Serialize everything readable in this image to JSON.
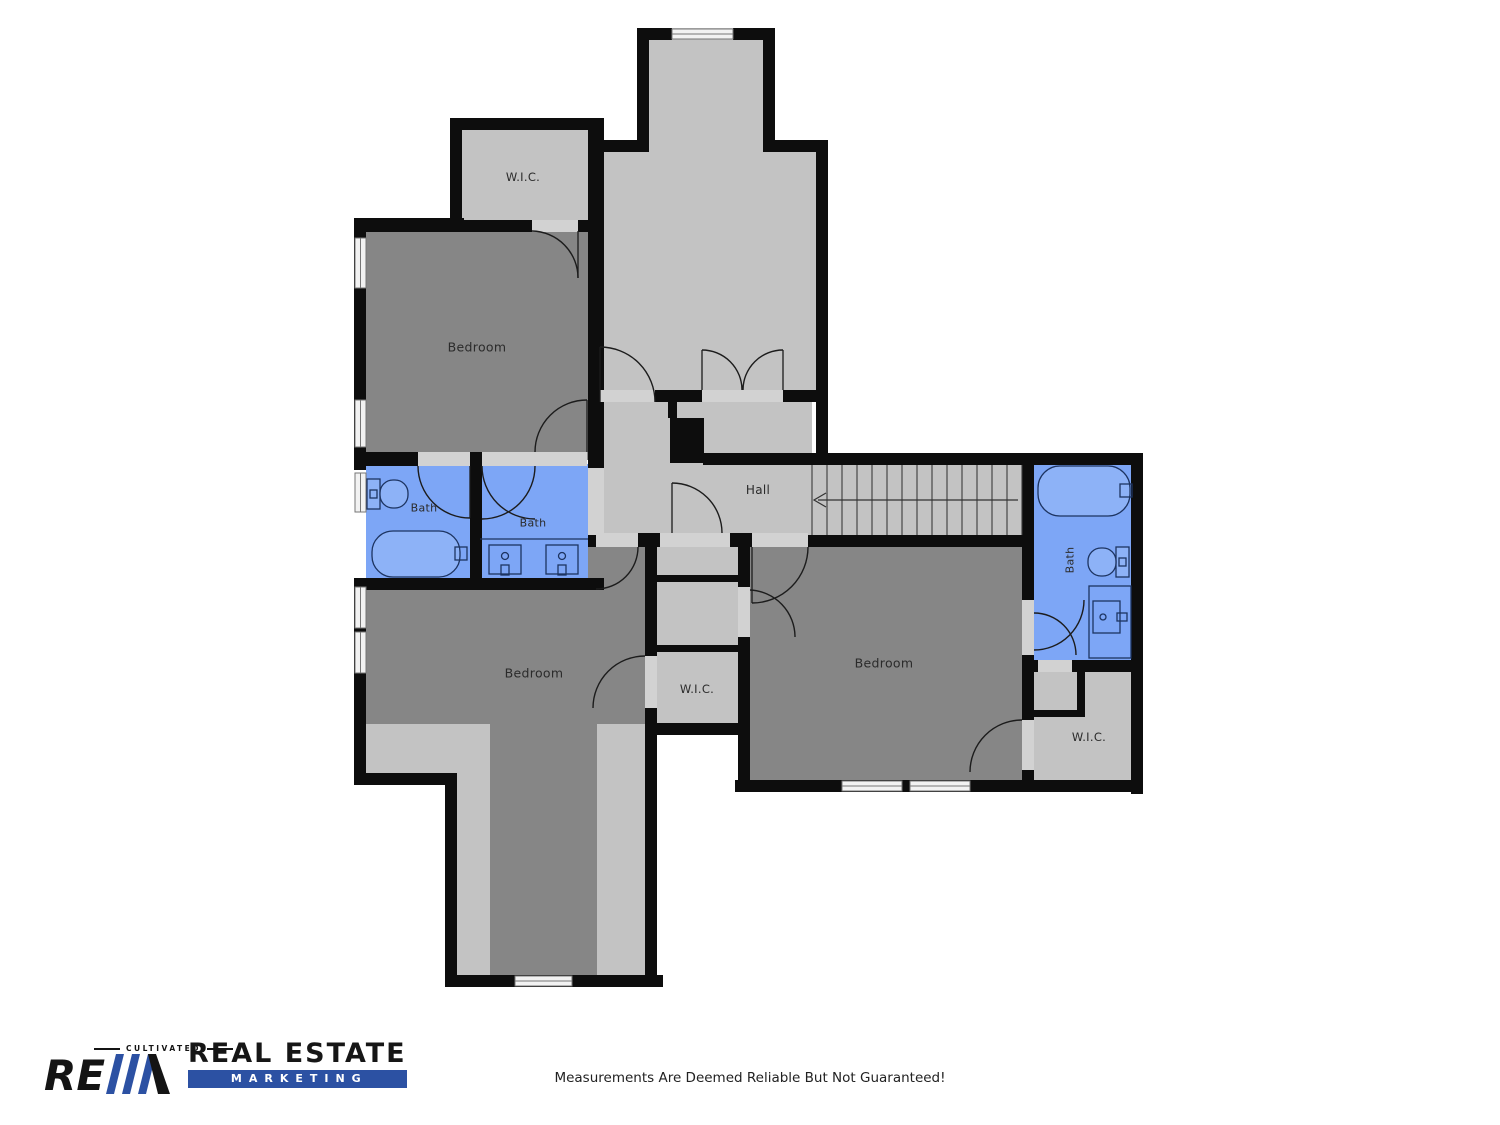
{
  "page": {
    "background": "#ffffff",
    "disclaimer": "Measurements Are Deemed Reliable But Not Guaranteed!"
  },
  "palette": {
    "wall": "#0d0d0d",
    "room_dark": "#868686",
    "room_light": "#c3c3c3",
    "bath_fill": "#7da6f6",
    "bath_fixture_fill": "#8db2f7",
    "fixture_stroke": "#1d3461",
    "casing": "#d2d2d2",
    "window_fill": "#f2f2f2",
    "door_arc": "#1c1c1c",
    "stair_line": "#3c3c3c",
    "label_color": "#2b2b2b",
    "logo_blue": "#2c51a3",
    "logo_black": "#141414"
  },
  "rooms": [
    {
      "id": "wic-upper-left",
      "label": "W.I.C.",
      "x": 523,
      "y": 177,
      "rot": 0,
      "fs": 11.5
    },
    {
      "id": "bedroom-upper-left",
      "label": "Bedroom",
      "x": 477,
      "y": 347,
      "rot": 0,
      "fs": 12.5
    },
    {
      "id": "bath-left",
      "label": "Bath",
      "x": 424,
      "y": 508,
      "rot": 0,
      "fs": 11
    },
    {
      "id": "bath-center",
      "label": "Bath",
      "x": 533,
      "y": 523,
      "rot": 0,
      "fs": 11
    },
    {
      "id": "hall",
      "label": "Hall",
      "x": 758,
      "y": 490,
      "rot": 0,
      "fs": 12
    },
    {
      "id": "bedroom-lower-left",
      "label": "Bedroom",
      "x": 534,
      "y": 673,
      "rot": 0,
      "fs": 12.5
    },
    {
      "id": "wic-center",
      "label": "W.I.C.",
      "x": 697,
      "y": 689,
      "rot": 0,
      "fs": 11.5
    },
    {
      "id": "bedroom-right",
      "label": "Bedroom",
      "x": 884,
      "y": 663,
      "rot": 0,
      "fs": 12.5
    },
    {
      "id": "bath-right",
      "label": "Bath",
      "x": 1070,
      "y": 560,
      "rot": -90,
      "fs": 11
    },
    {
      "id": "wic-lower-right",
      "label": "W.I.C.",
      "x": 1089,
      "y": 737,
      "rot": 0,
      "fs": 11.5
    }
  ],
  "stairs": {
    "treads": 14,
    "x1": 812,
    "x2": 1022,
    "y1": 465,
    "y2": 535,
    "arrow_y": 500,
    "direction_arrow": "left"
  },
  "logo": {
    "tagline": "CULTIVATED",
    "monogram": "RE",
    "brand": "REAL ESTATE",
    "sub": "MARKETING"
  }
}
